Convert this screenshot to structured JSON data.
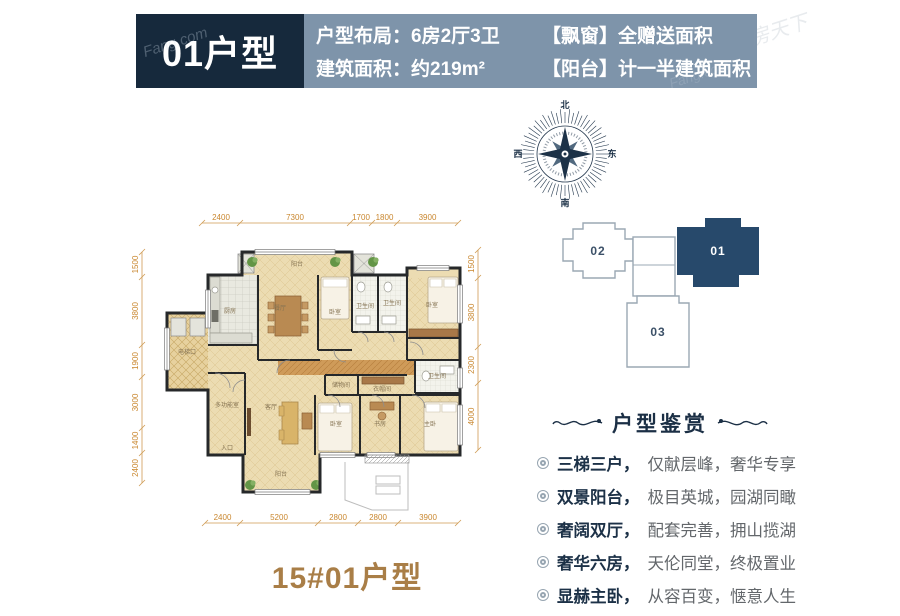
{
  "watermark": {
    "latin": "Fang.com",
    "cjk": "房天下"
  },
  "header": {
    "unit_title": "01户型",
    "line1": "户型布局：6房2厅3卫",
    "line2": "建筑面积：约219m²",
    "note1": "【飘窗】全赠送面积",
    "note2": "【阳台】计一半建筑面积"
  },
  "compass": {
    "n": "北",
    "e": "东",
    "s": "南",
    "w": "西"
  },
  "site_plan": {
    "units": [
      {
        "id": "02",
        "active": false
      },
      {
        "id": "01",
        "active": true
      },
      {
        "id": "03",
        "active": false
      }
    ]
  },
  "floor_plan": {
    "dims_top": [
      "2400",
      "7300",
      "1700",
      "1800",
      "3900"
    ],
    "dims_bottom": [
      "2400",
      "5200",
      "2800",
      "2800",
      "3900"
    ],
    "dims_left": [
      "1500",
      "3800",
      "1900",
      "3000",
      "1400",
      "2400"
    ],
    "dims_right": [
      "1500",
      "3800",
      "2300",
      "4000"
    ],
    "room_labels": [
      "阳台",
      "厨房",
      "餐厅",
      "卧室",
      "卫生间",
      "卫生间",
      "卧室",
      "电梯口",
      "多功能室",
      "客厅",
      "卧室",
      "书房",
      "主卧",
      "储物间",
      "衣帽间",
      "卫生间",
      "阳台",
      "入口"
    ]
  },
  "appreciation": {
    "title": "户型鉴赏",
    "items": [
      {
        "head": "三梯三户，",
        "tail": "仅献层峰，奢华专享"
      },
      {
        "head": "双景阳台，",
        "tail": "极目英城，园湖同瞰"
      },
      {
        "head": "奢阔双厅，",
        "tail": "配套完善，拥山揽湖"
      },
      {
        "head": "奢华六房，",
        "tail": "天伦同堂，终极置业"
      },
      {
        "head": "显赫主卧，",
        "tail": "从容百变，惬意人生"
      }
    ]
  },
  "footer": {
    "title": "15#01户型"
  }
}
